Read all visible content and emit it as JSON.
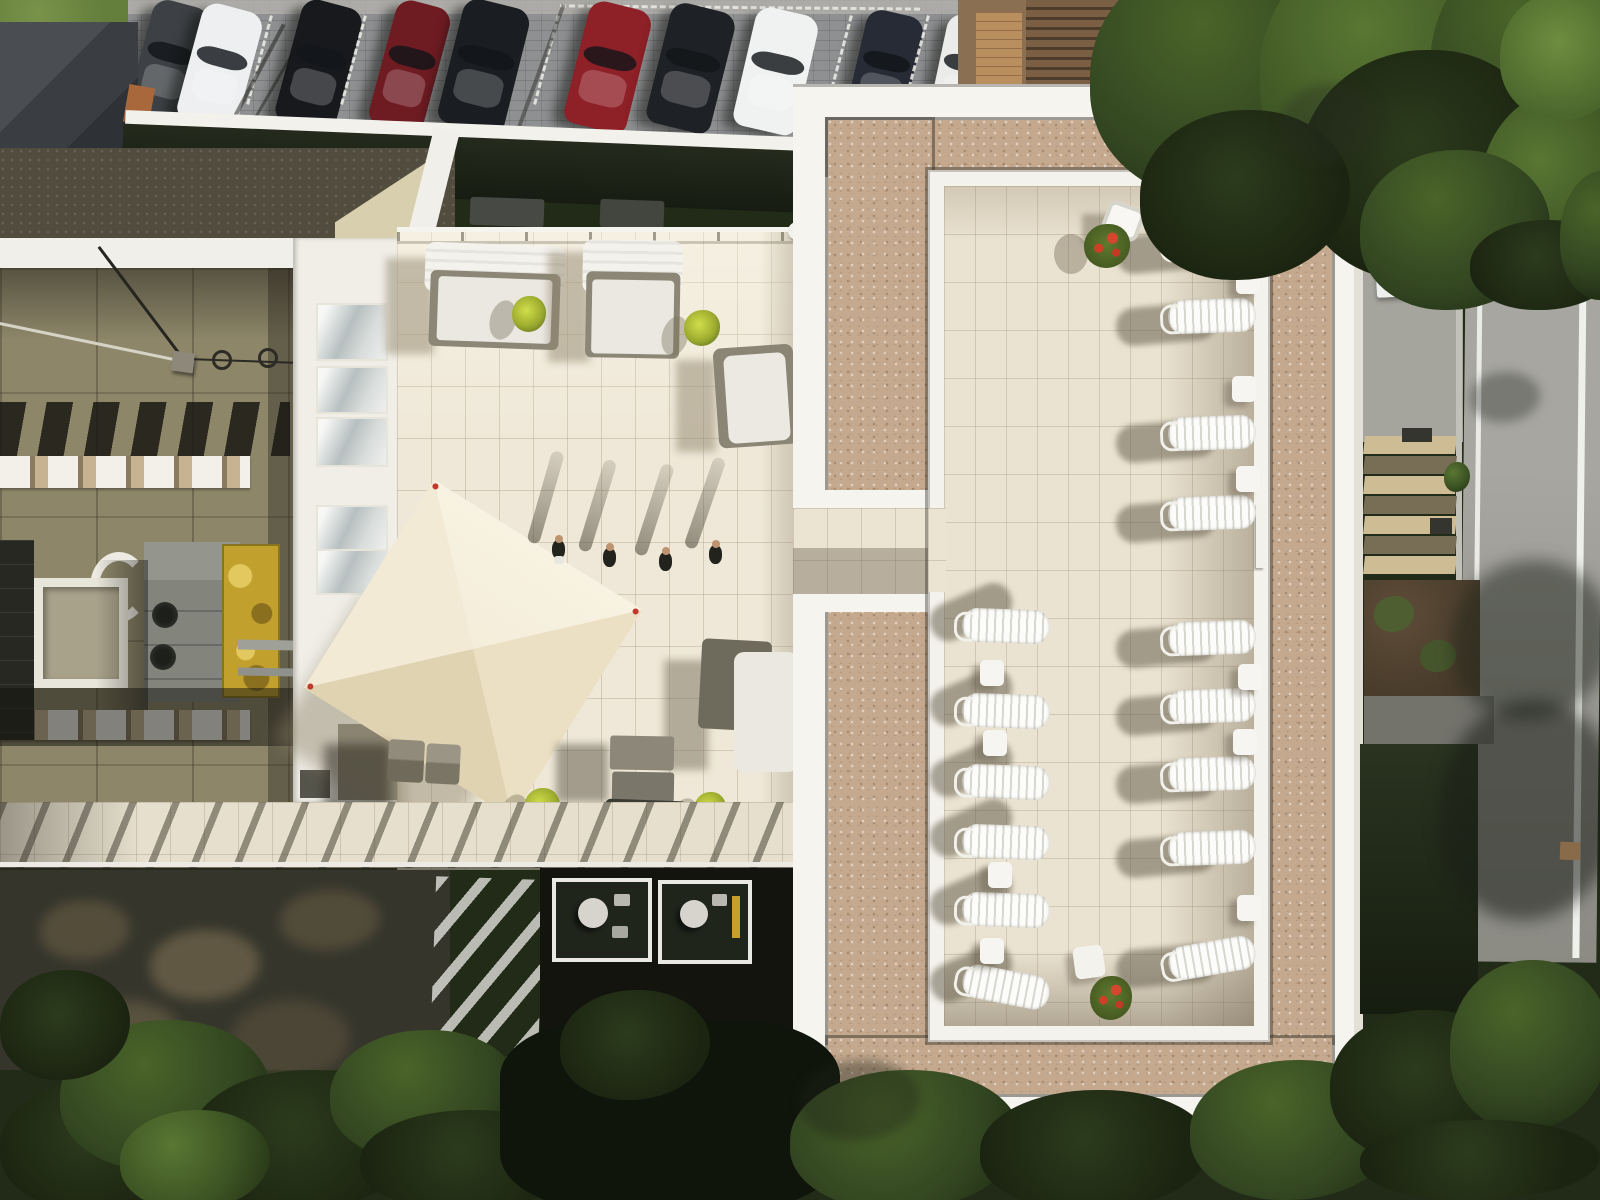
{
  "scene": {
    "type": "aerial-drone-photograph",
    "description": "Top-down drone view of a modern hotel rooftop: cream-tiled sun terrace with canopied daybeds, a pyramid parasol and four people walking; a gravel-bordered courtyard with rows of white sun loungers; a row of parked cars at top; trees and a road with white lane lines on the right",
    "time_of_day": "late afternoon with long shadows"
  },
  "palette": {
    "terrace_tile": "#efe8d8",
    "courtyard_tile": "#ebe3d1",
    "gravel": "#c4a98e",
    "roof_olive": "#8d8669",
    "parapet_white": "#f6f4ee",
    "tree_dark": "#2c3b1c",
    "tree_light": "#5a7733",
    "road_gray": "#9a9993",
    "hedge_dark": "#1f2616",
    "canopy_cream": "#f1e9d4",
    "accent_plant_yellow": "#d2de4a",
    "accent_flower_red": "#d2472e",
    "weathered_panel_yellow": "#c2a02e"
  },
  "parking": {
    "car_count": 10,
    "empty_spaces": 1,
    "cars": [
      {
        "color_name": "dark gray",
        "hex": "#3d4145"
      },
      {
        "color_name": "white",
        "hex": "#edeff0"
      },
      {
        "color_name": "black",
        "hex": "#17191d"
      },
      {
        "color_name": "dark red",
        "hex": "#6e1b22"
      },
      {
        "color_name": "black",
        "hex": "#1a1d21"
      },
      {
        "color_name": "red",
        "hex": "#8e2027"
      },
      {
        "color_name": "black",
        "hex": "#1e2126"
      },
      {
        "color_name": "white",
        "hex": "#f0f2f2"
      },
      {
        "color_name": "dark navy",
        "hex": "#262b36"
      },
      {
        "color_name": "white",
        "hex": "#ebece9"
      }
    ]
  },
  "terrace": {
    "daybeds_with_canopy": 2,
    "chaise_loungers": 2,
    "cube_seats": 2,
    "planters_yellow_green": 4,
    "people_walking": 4,
    "person_on_walkway": 1,
    "pyramid_canopy": 1
  },
  "courtyard": {
    "sun_loungers_right_row": 9,
    "sun_loungers_left_row": 6,
    "side_tables_right": 6,
    "side_tables_left": 4,
    "flower_planters": 2,
    "white_chairs": 1,
    "white_tables": 1,
    "ladder_on_wall": 1
  },
  "surroundings": {
    "balconies_below_terrace": 2,
    "stair_steps_right": 7,
    "road_lane_lines": 2,
    "pergola": 1,
    "wood_deck": 1,
    "manhole_cover": 1,
    "hvac_units": 3,
    "skylight": 1,
    "awning_banner": 1
  }
}
